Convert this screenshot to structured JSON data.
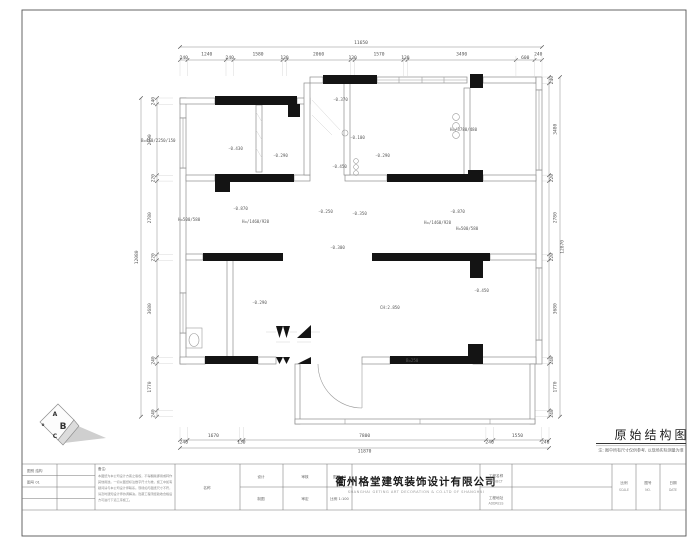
{
  "drawing_title": {
    "text": "原始结构图",
    "note": "注: 图中所有尺寸仅供参考, 以现场实际测量为准"
  },
  "dimensions": {
    "top": {
      "total": "11650",
      "segments": [
        "240",
        "1240",
        "240",
        "1580",
        "130",
        "2060",
        "130",
        "1570",
        "130",
        "3490",
        "600",
        "240"
      ]
    },
    "bottom": {
      "total": "11870",
      "segments": [
        "240",
        "1670",
        "130",
        "7800",
        "240",
        "1550",
        "240"
      ]
    },
    "left": {
      "total": "12080",
      "segments": [
        "240",
        "2690",
        "220",
        "2780",
        "220",
        "3680",
        "240",
        "1770",
        "240"
      ]
    },
    "right": {
      "total": "12870",
      "segments": [
        "240",
        "3480",
        "220",
        "2780",
        "220",
        "3680",
        "240",
        "1770",
        "240"
      ]
    }
  },
  "plan": {
    "labels": [
      "-0.370",
      "-0.430",
      "-0.100",
      "-0.290",
      "-0.290",
      "-0.450",
      "-0.870",
      "-0.870",
      "-0.250",
      "-0.350",
      "-0.300",
      "-0.450",
      "-0.290",
      "CH:2.850",
      "B=250",
      "H=/3780/480",
      "B=410/2250/150",
      "H=500/580",
      "H=/1460/920",
      "H=/1460/920",
      "H=500/580"
    ]
  },
  "logo": {
    "a": "A",
    "b": "B",
    "c": "C",
    "o": "o"
  },
  "title_block": {
    "col_a": [
      "图别  结构",
      "图号  01",
      "",
      ""
    ],
    "notes_title": "备注:",
    "notes": [
      "本图纸为本公司设计方案之版权，不得翻版挪用或转作",
      "其他用途。一切以图纸标注数字尺寸为准，施工中如有",
      "疑问请与本公司设计师联系。现场如与图纸尺寸不符，",
      "请及时通知设计师协调解决。隐蔽工程须经验收合格后",
      "方可进行下道工序施工。"
    ],
    "name_label": "名称",
    "mid": {
      "c1r1": "设计",
      "c1r2": "制图",
      "c2r1": "审核",
      "c2r2": "审定",
      "c3r1": "图幅 A3",
      "c3r2": "比例 1:100"
    },
    "company": "衢州格堂建筑装饰设计有限公司",
    "company_en": "SHANGHAI GETING ART DECORATION & CO.LTD OF SHANGHAI",
    "proj_label": "工程名称",
    "proj_en": "PROJECT",
    "addr_label": "工程地址",
    "addr_en": "ADDRESS",
    "scale_label": "比例",
    "scale_en": "SCALE",
    "no_label": "图号",
    "no_en": "NO.",
    "date_label": "日期",
    "date_en": "DATE"
  },
  "colors": {
    "wall_black": "#141414",
    "wall_light": "#8e8e8e",
    "dim_text": "#555555"
  }
}
